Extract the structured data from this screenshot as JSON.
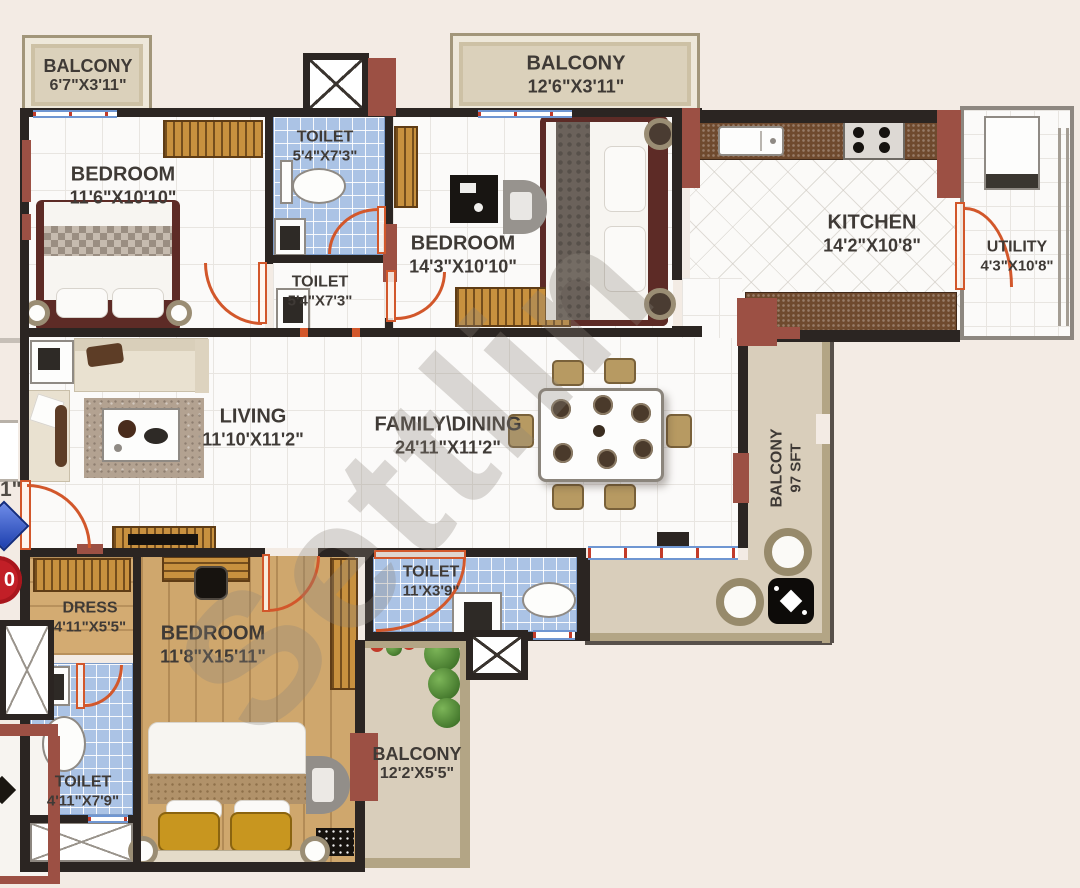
{
  "annotations": {
    "watermark": "Settlin",
    "edge_dimension_fragment": "1\"",
    "edge_badge": "0"
  },
  "palette": {
    "wall": "#2b2522",
    "column_red": "#9c5044",
    "door_orange": "#d2572b",
    "toilet_tile_blue": "#abc3e5",
    "wood_floor": "#cfa76d",
    "balcony_beige": "#d9cebb",
    "background": "#f3ebe4"
  },
  "rooms": [
    {
      "id": "balcony-top-left",
      "name": "BALCONY",
      "dims": "6'7\"X3'11\""
    },
    {
      "id": "balcony-top-center",
      "name": "BALCONY",
      "dims": "12'6\"X3'11\""
    },
    {
      "id": "bedroom-1",
      "name": "BEDROOM",
      "dims": "11'6\"X10'10\""
    },
    {
      "id": "toilet-1",
      "name": "TOILET",
      "dims": "5'4\"X7'3\""
    },
    {
      "id": "toilet-2",
      "name": "TOILET",
      "dims": "5'4\"X7'3\""
    },
    {
      "id": "bedroom-2",
      "name": "BEDROOM",
      "dims": "14'3\"X10'10\""
    },
    {
      "id": "kitchen",
      "name": "KITCHEN",
      "dims": "14'2\"X10'8\""
    },
    {
      "id": "utility",
      "name": "UTILITY",
      "dims": "4'3\"X10'8\""
    },
    {
      "id": "living",
      "name": "LIVING",
      "dims": "11'10'X11'2\""
    },
    {
      "id": "family-dining",
      "name": "FAMILY\\DINING",
      "dims": "24'11\"X11'2\""
    },
    {
      "id": "balcony-right",
      "name": "BALCONY",
      "dims": "97 SFT"
    },
    {
      "id": "dress",
      "name": "DRESS",
      "dims": "4'11\"X5'5\""
    },
    {
      "id": "bedroom-3",
      "name": "BEDROOM",
      "dims": "11'8\"X15'11\""
    },
    {
      "id": "toilet-3",
      "name": "TOILET",
      "dims": "4'11\"X7'9\""
    },
    {
      "id": "toilet-4",
      "name": "TOILET",
      "dims": "11'X3'9\""
    },
    {
      "id": "balcony-bottom",
      "name": "BALCONY",
      "dims": "12'2'X5'5\""
    }
  ]
}
